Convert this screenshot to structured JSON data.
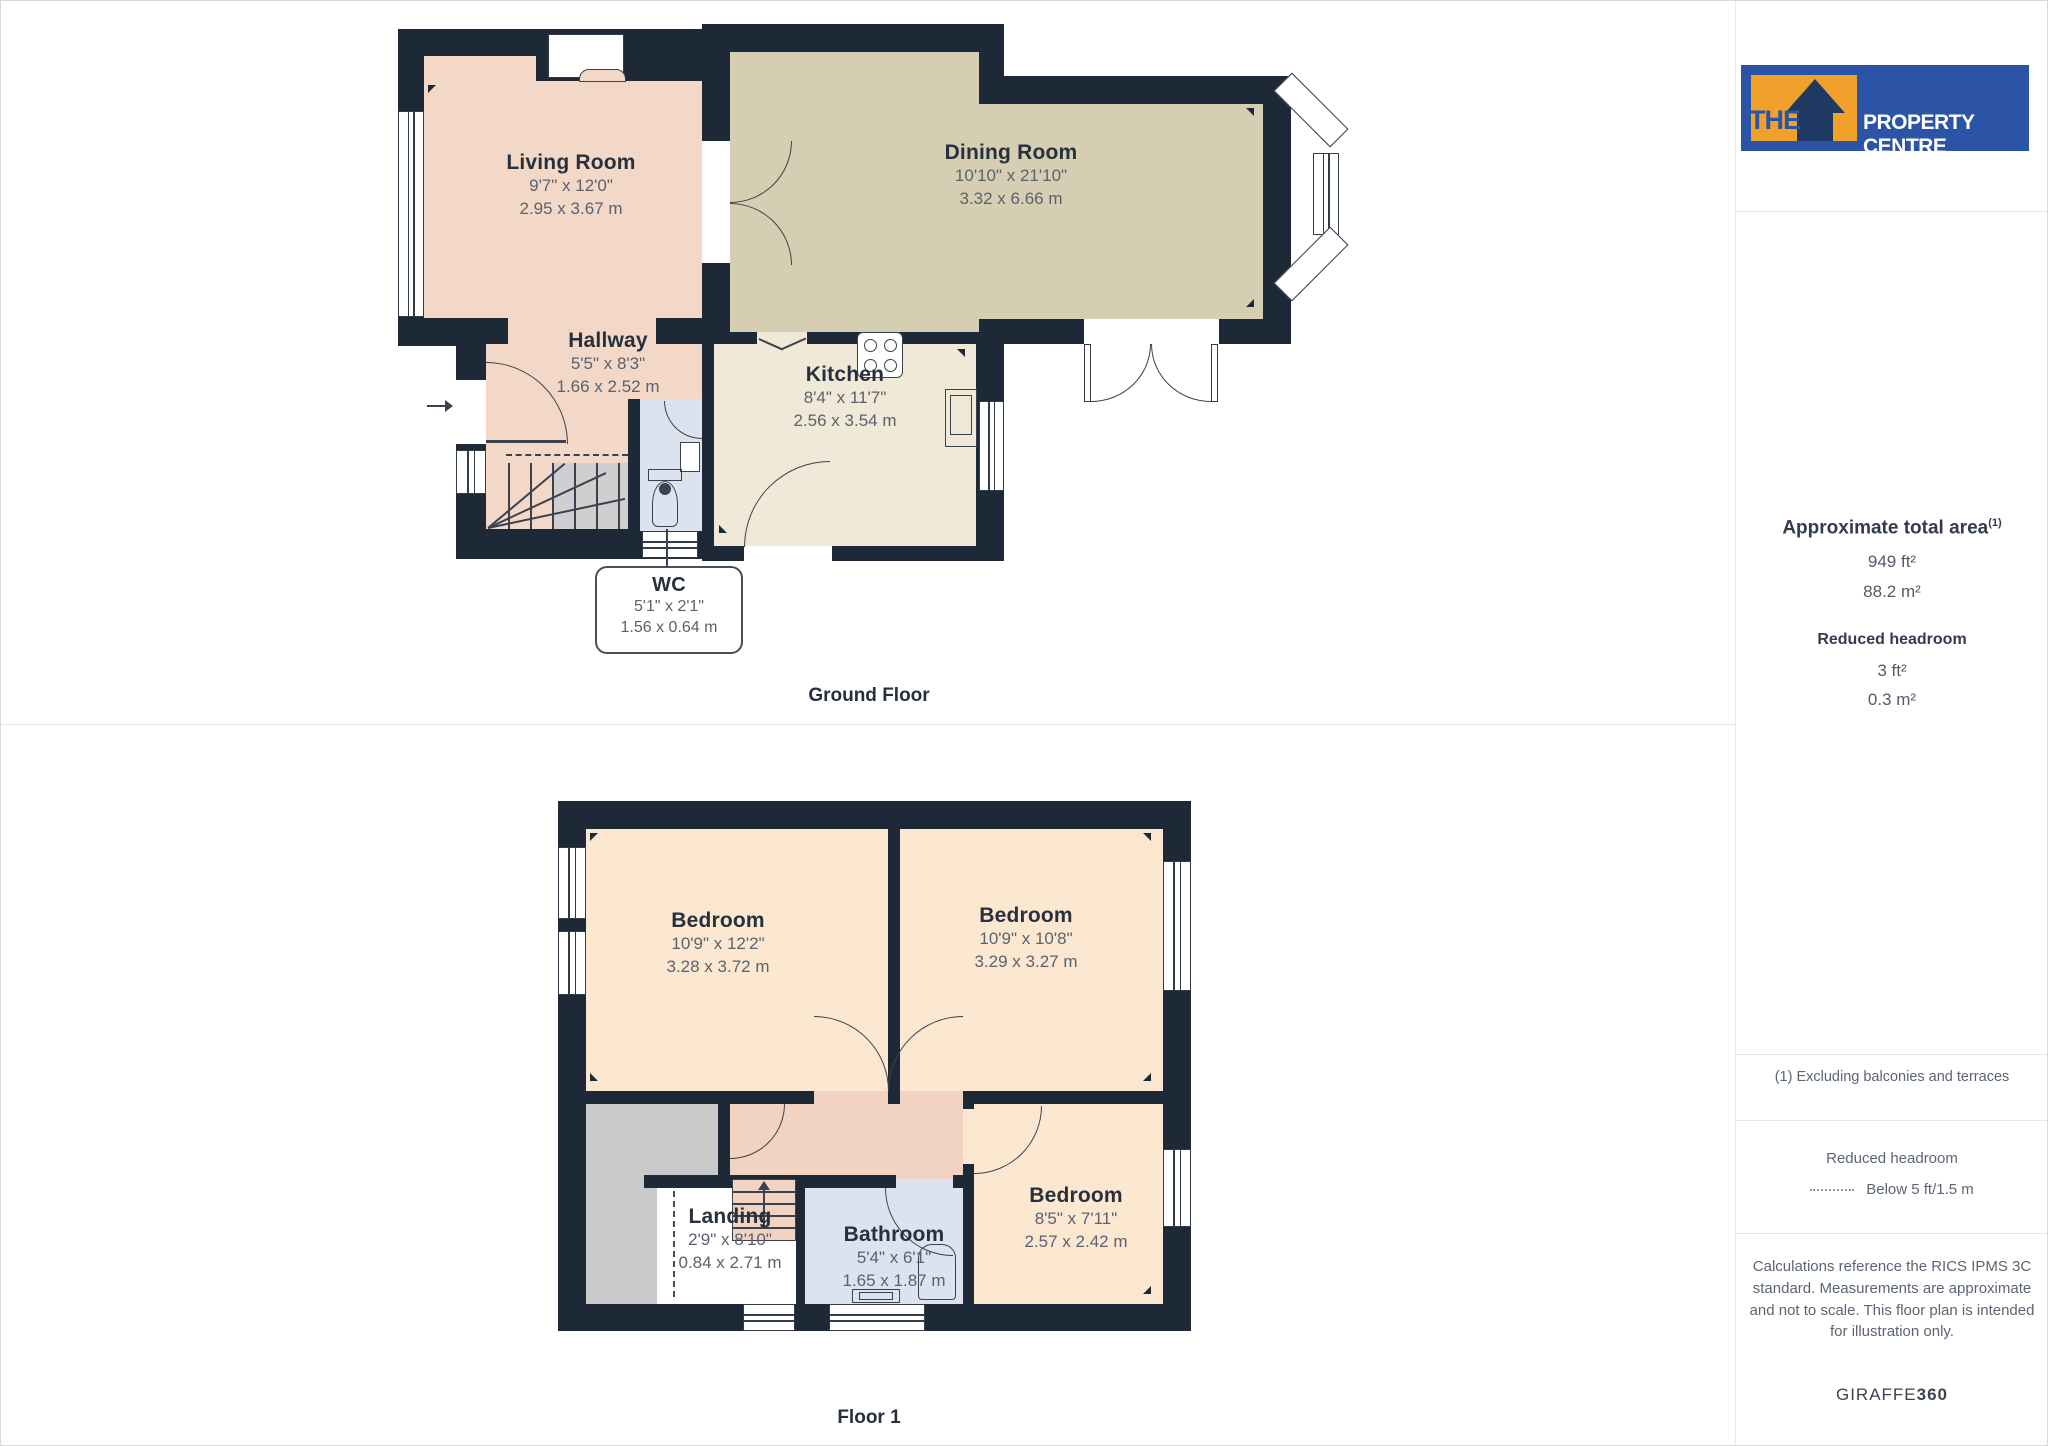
{
  "brand": {
    "the": "THE",
    "rest": "PROPERTY CENTRE"
  },
  "sidebar": {
    "total_area_label": "Approximate total area",
    "total_area_sup": "(1)",
    "total_area_ft": "949 ft²",
    "total_area_m": "88.2 m²",
    "reduced_headroom_label": "Reduced headroom",
    "reduced_headroom_ft": "3 ft²",
    "reduced_headroom_m": "0.3 m²",
    "note": "(1) Excluding balconies and terraces",
    "legend_title": "Reduced headroom",
    "legend_value": "Below 5 ft/1.5 m",
    "disclaimer": "Calculations reference the RICS IPMS 3C standard. Measurements are approximate and not to scale. This floor plan is intended for illustration only.",
    "credit_normal": "GIRAFFE",
    "credit_bold": "360"
  },
  "floors": [
    {
      "label": "Ground Floor",
      "rooms": [
        {
          "name": "Living Room",
          "imperial": "9'7\" x 12'0\"",
          "metric": "2.95 x 3.67 m"
        },
        {
          "name": "Dining Room",
          "imperial": "10'10\" x 21'10\"",
          "metric": "3.32 x 6.66 m"
        },
        {
          "name": "Hallway",
          "imperial": "5'5\" x 8'3\"",
          "metric": "1.66 x 2.52 m"
        },
        {
          "name": "Kitchen",
          "imperial": "8'4\" x 11'7\"",
          "metric": "2.56 x 3.54 m"
        },
        {
          "name": "WC",
          "imperial": "5'1\" x 2'1\"",
          "metric": "1.56 x 0.64 m"
        }
      ]
    },
    {
      "label": "Floor 1",
      "rooms": [
        {
          "name": "Bedroom",
          "imperial": "10'9\" x 12'2\"",
          "metric": "3.28 x 3.72 m"
        },
        {
          "name": "Bedroom",
          "imperial": "10'9\" x 10'8\"",
          "metric": "3.29 x 3.27 m"
        },
        {
          "name": "Landing",
          "imperial": "2'9\" x 8'10\"",
          "metric": "0.84 x 2.71 m"
        },
        {
          "name": "Bathroom",
          "imperial": "5'4\" x 6'1\"",
          "metric": "1.65 x 1.87 m"
        },
        {
          "name": "Bedroom",
          "imperial": "8'5\" x 7'11\"",
          "metric": "2.57 x 2.42 m"
        }
      ]
    }
  ],
  "colors": {
    "wall": "#1d2936",
    "brand_blue": "#2b54a6",
    "brand_orange": "#f0a12c",
    "living": "#f3d8c7",
    "dining": "#d6ceb2",
    "kitchen": "#f0e9d7",
    "wet_room": "#dce3ef",
    "bedroom": "#fce8d1",
    "corridor": "#f2d3c2",
    "reduced_gray": "#c9c9c9"
  }
}
